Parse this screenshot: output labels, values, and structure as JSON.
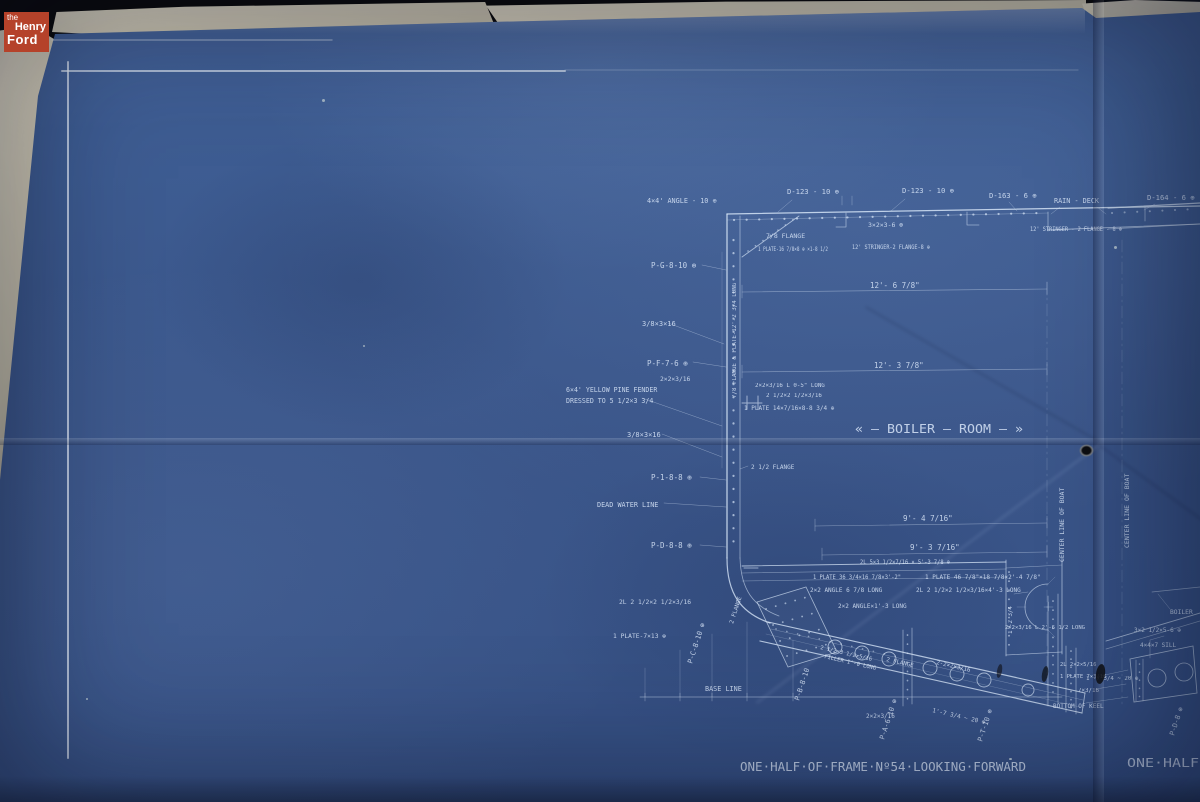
{
  "logo": {
    "line1": "the",
    "line2": "Henry",
    "line3": "Ford"
  },
  "colors": {
    "backdrop": "#0a0908",
    "blueprint_blue": "#3c5a90",
    "line_white": "#d5e4f6",
    "paper_cream": "#d8d1bc",
    "logo_red": "#b5422a"
  },
  "blueprint": {
    "annotations": [
      {
        "t": "4×4' ANGLE - 10 ⊕",
        "x": 647,
        "y": 203,
        "s": 6.8
      },
      {
        "t": "D-123 - 10 ⊕",
        "x": 787,
        "y": 194,
        "s": 7.2
      },
      {
        "t": "D-123 - 10 ⊕",
        "x": 902,
        "y": 193,
        "s": 7.2
      },
      {
        "t": "3×2×3-6 ⊕",
        "x": 868,
        "y": 227,
        "s": 6.5
      },
      {
        "t": "7/8 FLANGE",
        "x": 766,
        "y": 238,
        "s": 6.5
      },
      {
        "t": "1 PLATE-16 7/8×8 ⊕ ×1-8 1/2",
        "x": 758,
        "y": 251,
        "s": 6,
        "w": 70
      },
      {
        "t": "12' STRINGER-2 FLANGE-8 ⊕",
        "x": 852,
        "y": 249,
        "s": 6.2,
        "w": 78
      },
      {
        "t": "D-163 - 6 ⊕",
        "x": 989,
        "y": 198,
        "s": 7.2
      },
      {
        "t": "RAIN - DECK",
        "x": 1054,
        "y": 203,
        "s": 6.8
      },
      {
        "t": "12' STRINGER - 2 FLANGE - 8 ⊕",
        "x": 1030,
        "y": 231,
        "s": 6.2,
        "w": 92
      },
      {
        "t": "D-164 - 6 ⊕",
        "x": 1147,
        "y": 200,
        "s": 7.2
      },
      {
        "t": "P-G-8-10 ⊕",
        "x": 651,
        "y": 268,
        "s": 7.5
      },
      {
        "t": "3/8×3×16",
        "x": 642,
        "y": 326,
        "s": 7
      },
      {
        "t": "P-F-7-6 ⊕",
        "x": 647,
        "y": 366,
        "s": 7.5
      },
      {
        "t": "2×2×3/16",
        "x": 660,
        "y": 381,
        "s": 6.3
      },
      {
        "t": "6×4' YELLOW PINE FENDER",
        "x": 566,
        "y": 392,
        "s": 6.6
      },
      {
        "t": "DRESSED TO 5 1/2×3 3/4",
        "x": 566,
        "y": 403,
        "s": 6.6
      },
      {
        "t": "3/8×3×16",
        "x": 627,
        "y": 437,
        "s": 7
      },
      {
        "t": "P-1-8-8 ⊕",
        "x": 651,
        "y": 480,
        "s": 7.5
      },
      {
        "t": "DEAD WATER LINE",
        "x": 597,
        "y": 507,
        "s": 6.8,
        "n": "dead-water-line-label"
      },
      {
        "t": "P-D-8-8 ⊕",
        "x": 651,
        "y": 548,
        "s": 7.5
      },
      {
        "t": "7/8 FLANGE & PLATE-12'-2 3/4 LONG",
        "x": 736,
        "y": 398,
        "r": -90,
        "s": 5.8
      },
      {
        "t": "2×2×3/16 L 0-5\" LONG",
        "x": 755,
        "y": 387,
        "s": 5.8
      },
      {
        "t": "2 1/2×2 1/2×3/16",
        "x": 766,
        "y": 397,
        "s": 5.8
      },
      {
        "t": "1 PLATE 14×7/16×8-8 3/4 ⊕",
        "x": 744,
        "y": 410,
        "s": 6
      },
      {
        "t": "2 1/2 FLANGE",
        "x": 751,
        "y": 469,
        "s": 6
      },
      {
        "t": "12'- 6 7/8\"",
        "x": 870,
        "y": 288,
        "s": 7.5
      },
      {
        "t": "12'- 3 7/8\"",
        "x": 874,
        "y": 368,
        "s": 7.5
      },
      {
        "t": "« – BOILER – ROOM – »",
        "x": 855,
        "y": 433,
        "s": 12,
        "w": 168,
        "n": "boiler-room-label"
      },
      {
        "t": "9'- 4 7/16\"",
        "x": 903,
        "y": 521,
        "s": 7.5
      },
      {
        "t": "9'- 3 7/16\"",
        "x": 910,
        "y": 550,
        "s": 7.5
      },
      {
        "t": "2L 5×3 1/2×7/16 × 5'-3 7/8 ⊕",
        "x": 860,
        "y": 564,
        "s": 6,
        "w": 90
      },
      {
        "t": "1 PLATE 36 3/4×16 7/8×3'-2\"",
        "x": 813,
        "y": 579,
        "s": 6,
        "w": 88
      },
      {
        "t": "1 PLATE 46 7/8\"×18 7/8×2'-4 7/8\"",
        "x": 925,
        "y": 579,
        "s": 6
      },
      {
        "t": "2×2 ANGLE 6 7/8 LONG",
        "x": 810,
        "y": 592,
        "s": 6
      },
      {
        "t": "2L 2 1/2×2 1/2×3/16×4'-3 LONG",
        "x": 916,
        "y": 592,
        "s": 6
      },
      {
        "t": "2×2 ANGLE×1'-3 LONG",
        "x": 838,
        "y": 608,
        "s": 6
      },
      {
        "t": "2×2×3/16 L 2'-6 1/2 LONG",
        "x": 1005,
        "y": 629,
        "s": 5.5,
        "w": 80
      },
      {
        "t": "1'-2 3/4",
        "x": 1012,
        "y": 634,
        "r": -90,
        "s": 5.8
      },
      {
        "t": "2L 2 1/2×2 1/2×3/16",
        "x": 619,
        "y": 604,
        "s": 6.3
      },
      {
        "t": "1 PLATE-7×13 ⊕",
        "x": 613,
        "y": 638,
        "s": 6.3
      },
      {
        "t": "P-C-8-10 ⊕",
        "x": 692,
        "y": 664,
        "r": -72,
        "s": 7
      },
      {
        "t": "2 FLANGE",
        "x": 733,
        "y": 624,
        "r": -72,
        "s": 5.8
      },
      {
        "t": "BASE LINE",
        "x": 705,
        "y": 691,
        "s": 6.8,
        "n": "base-line-label"
      },
      {
        "t": "P-B-8-10",
        "x": 799,
        "y": 701,
        "r": -72,
        "s": 7
      },
      {
        "t": "2 1/2×3 1/2×5/16",
        "x": 820,
        "y": 649,
        "r": 13,
        "s": 5.5
      },
      {
        "t": "FILLER 1'-0 LONG",
        "x": 824,
        "y": 658,
        "r": 13,
        "s": 5.5
      },
      {
        "t": "2 FLANGE",
        "x": 886,
        "y": 661,
        "r": 13,
        "s": 5.8
      },
      {
        "t": "2-2×2×3/16",
        "x": 936,
        "y": 664,
        "r": 13,
        "s": 5.8
      },
      {
        "t": "2×2×3/16",
        "x": 866,
        "y": 718,
        "s": 6
      },
      {
        "t": "1'-7 3/4 ~ 20 ⊕",
        "x": 932,
        "y": 712,
        "r": 13,
        "s": 6
      },
      {
        "t": "P-A-6-10 ⊕",
        "x": 884,
        "y": 740,
        "r": -72,
        "s": 7
      },
      {
        "t": "P-T-10 ⊕",
        "x": 982,
        "y": 742,
        "r": -72,
        "s": 7
      },
      {
        "t": "CENTER LINE OF BOAT",
        "x": 1064,
        "y": 562,
        "r": -90,
        "s": 6.5
      },
      {
        "t": "CENTER LINE OF BOAT",
        "x": 1129,
        "y": 548,
        "r": -90,
        "s": 6.5
      },
      {
        "t": "BOILER",
        "x": 1170,
        "y": 614,
        "s": 6.3
      },
      {
        "t": "3×2 1/2×5-6 ⊕",
        "x": 1134,
        "y": 632,
        "s": 6
      },
      {
        "t": "4×4×7 SILL",
        "x": 1140,
        "y": 647,
        "s": 6
      },
      {
        "t": "2L 2×2×5/16",
        "x": 1060,
        "y": 666,
        "s": 5.5
      },
      {
        "t": "1 PLATE 7×3/16",
        "x": 1060,
        "y": 678,
        "s": 5.5
      },
      {
        "t": "1'-7 3/4 ~ 20 ⊕",
        "x": 1086,
        "y": 680,
        "s": 5.8
      },
      {
        "t": "7×3/16",
        "x": 1078,
        "y": 692,
        "s": 5.8
      },
      {
        "t": "BOTTOM OF KEEL",
        "x": 1053,
        "y": 708,
        "s": 6
      },
      {
        "t": "P-D-8 ⊕",
        "x": 1174,
        "y": 736,
        "r": -72,
        "s": 7
      },
      {
        "t": "ONE·HALF·OF·FRAME·Nº54·LOOKING·FORWARD",
        "x": 740,
        "y": 771,
        "s": 12,
        "w": 286,
        "n": "title-frame-54"
      },
      {
        "t": "ONE·HALF",
        "x": 1127,
        "y": 767,
        "s": 12,
        "w": 72,
        "n": "title-right-fragment"
      }
    ]
  }
}
